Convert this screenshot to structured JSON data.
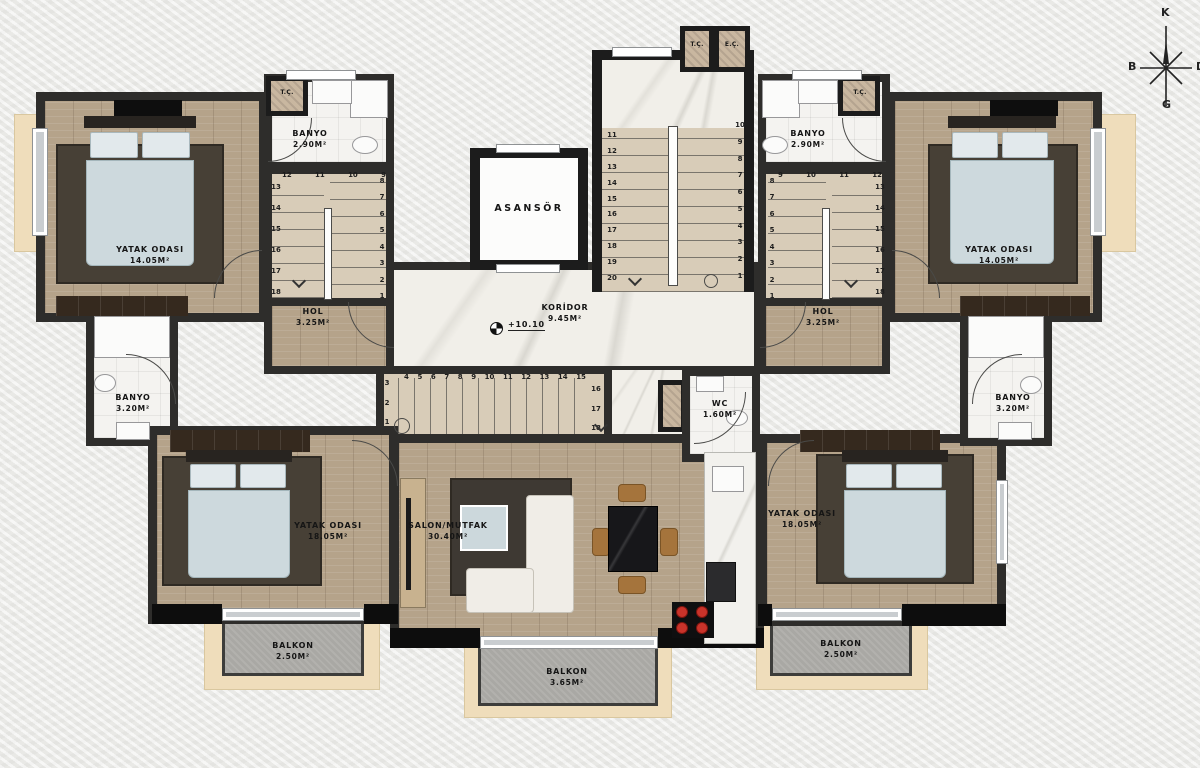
{
  "compass": {
    "north": "K",
    "west": "B",
    "east": "D",
    "south": "G"
  },
  "elevation": "+10.10",
  "labels": {
    "bedroom_tl": {
      "name": "YATAK ODASI",
      "area": "14.05M²"
    },
    "bedroom_tr": {
      "name": "YATAK ODASI",
      "area": "14.05M²"
    },
    "bedroom_bl": {
      "name": "YATAK ODASI",
      "area": "18.05M²"
    },
    "bedroom_br": {
      "name": "YATAK ODASI",
      "area": "18.05M²"
    },
    "banyo_tl": {
      "name": "BANYO",
      "area": "2.90M²"
    },
    "banyo_tr": {
      "name": "BANYO",
      "area": "2.90M²"
    },
    "banyo_ml": {
      "name": "BANYO",
      "area": "3.20M²"
    },
    "banyo_mr": {
      "name": "BANYO",
      "area": "3.20M²"
    },
    "hol_l": {
      "name": "HOL",
      "area": "3.25M²"
    },
    "hol_r": {
      "name": "HOL",
      "area": "3.25M²"
    },
    "asansor": {
      "name": "ASANSÖR"
    },
    "koridor": {
      "name": "KORİDOR",
      "area": "9.45M²"
    },
    "salon": {
      "name": "SALON/MUTFAK",
      "area": "30.40M²"
    },
    "wc": {
      "name": "WC",
      "area": "1.60M²"
    },
    "balkon_l": {
      "name": "BALKON",
      "area": "2.50M²"
    },
    "balkon_c": {
      "name": "BALKON",
      "area": "3.65M²"
    },
    "balkon_r": {
      "name": "BALKON",
      "area": "2.50M²"
    }
  },
  "shafts": {
    "tl": "T.Ç.",
    "tr": "T.Ç.",
    "stair_t": "T.Ç.",
    "stair_e": "E.Ç."
  },
  "stairs": {
    "left": {
      "top": [
        "12",
        "11",
        "10",
        "9"
      ],
      "left_col": [
        "13",
        "14",
        "15",
        "16",
        "17",
        "18"
      ],
      "right_col": [
        "8",
        "7",
        "6",
        "5",
        "4",
        "3",
        "2",
        "1"
      ]
    },
    "right": {
      "top": [
        "9",
        "10",
        "11",
        "12"
      ],
      "left_col": [
        "8",
        "7",
        "6",
        "5",
        "4",
        "3",
        "2",
        "1"
      ],
      "right_col": [
        "13",
        "14",
        "15",
        "16",
        "17",
        "18"
      ]
    },
    "center": {
      "left_col": [
        "11",
        "12",
        "13",
        "14",
        "15",
        "16",
        "17",
        "18",
        "19",
        "20"
      ],
      "right_col": [
        "10",
        "9",
        "8",
        "7",
        "6",
        "5",
        "4",
        "3",
        "2",
        "1"
      ]
    },
    "bottom": {
      "left_col": [
        "3",
        "2",
        "1"
      ],
      "top": [
        "4",
        "5",
        "6",
        "7",
        "8",
        "9",
        "10",
        "11",
        "12",
        "13",
        "14",
        "15"
      ],
      "right_col": [
        "16",
        "17",
        "18"
      ]
    }
  }
}
